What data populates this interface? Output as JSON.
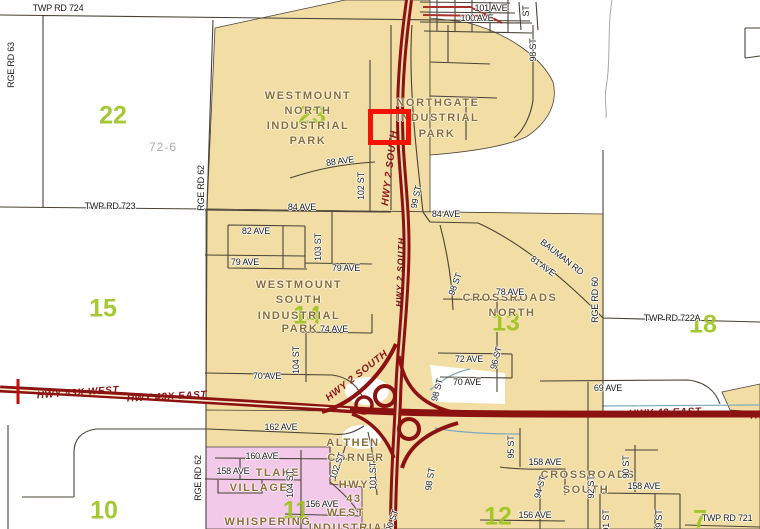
{
  "colors": {
    "tan": "#F2DEA5",
    "pink": "#F2C9E9",
    "hwy": "#8C1111",
    "selection": "#F31208",
    "section": "#9CC41F",
    "place": "#8A6D35",
    "street": "#1C1C1C",
    "hwylabel": "#8A1515",
    "teal": "#7FA9BE",
    "creek": "#A8A8A8",
    "road": "#4A4238"
  },
  "selection": {
    "x": 368,
    "y": 109,
    "w": 33,
    "h": 26
  },
  "labels": [
    {
      "t": "22",
      "x": 113,
      "y": 116,
      "r": 0,
      "c": "section"
    },
    {
      "t": "23",
      "x": 312,
      "y": 116,
      "r": 0,
      "c": "section"
    },
    {
      "t": "15",
      "x": 103,
      "y": 309,
      "r": 0,
      "c": "section"
    },
    {
      "t": "14",
      "x": 307,
      "y": 316,
      "r": 0,
      "c": "section"
    },
    {
      "t": "13",
      "x": 506,
      "y": 323,
      "r": 0,
      "c": "section"
    },
    {
      "t": "18",
      "x": 703,
      "y": 325,
      "r": 0,
      "c": "section"
    },
    {
      "t": "10",
      "x": 104,
      "y": 511,
      "r": 0,
      "c": "section"
    },
    {
      "t": "11",
      "x": 296,
      "y": 511,
      "r": 0,
      "c": "section"
    },
    {
      "t": "12",
      "x": 498,
      "y": 517,
      "r": 0,
      "c": "section"
    },
    {
      "t": "7",
      "x": 700,
      "y": 520,
      "r": 0,
      "c": "section"
    },
    {
      "t": "72-6",
      "x": 163,
      "y": 147,
      "r": 0,
      "c": "lot"
    },
    {
      "t": "WESTMOUNT",
      "x": 308,
      "y": 96,
      "r": 0,
      "c": "place"
    },
    {
      "t": "NORTH",
      "x": 308,
      "y": 111,
      "r": 0,
      "c": "place"
    },
    {
      "t": "INDUSTRIAL",
      "x": 308,
      "y": 126,
      "r": 0,
      "c": "place"
    },
    {
      "t": "PARK",
      "x": 308,
      "y": 141,
      "r": 0,
      "c": "place"
    },
    {
      "t": "NORTHGATE",
      "x": 438,
      "y": 103,
      "r": 0,
      "c": "place"
    },
    {
      "t": "INDUSTRIAL",
      "x": 438,
      "y": 118,
      "r": 0,
      "c": "place"
    },
    {
      "t": "PARK",
      "x": 437,
      "y": 134,
      "r": 0,
      "c": "place"
    },
    {
      "t": "WESTMOUNT",
      "x": 299,
      "y": 285,
      "r": 0,
      "c": "place"
    },
    {
      "t": "SOUTH",
      "x": 299,
      "y": 300,
      "r": 0,
      "c": "place"
    },
    {
      "t": "INDUSTRIAL",
      "x": 299,
      "y": 316,
      "r": 0,
      "c": "place"
    },
    {
      "t": "PARK",
      "x": 300,
      "y": 329,
      "r": 0,
      "c": "place"
    },
    {
      "t": "CROSSROADS",
      "x": 510,
      "y": 298,
      "r": 0,
      "c": "place"
    },
    {
      "t": "NORTH",
      "x": 512,
      "y": 313,
      "r": 0,
      "c": "place"
    },
    {
      "t": "CROSSROADS",
      "x": 588,
      "y": 475,
      "r": 0,
      "c": "place"
    },
    {
      "t": "SOUTH",
      "x": 586,
      "y": 490,
      "r": 0,
      "c": "place"
    },
    {
      "t": "ALTHEN",
      "x": 353,
      "y": 443,
      "r": 0,
      "c": "place"
    },
    {
      "t": "CORNER",
      "x": 356,
      "y": 458,
      "r": 0,
      "c": "place"
    },
    {
      "t": "HWY",
      "x": 354,
      "y": 485,
      "r": 0,
      "c": "place"
    },
    {
      "t": "43",
      "x": 354,
      "y": 499,
      "r": 0,
      "c": "place"
    },
    {
      "t": "TLAKE",
      "x": 278,
      "y": 473,
      "r": 0,
      "c": "place"
    },
    {
      "t": "VILLAGE",
      "x": 259,
      "y": 488,
      "r": 0,
      "c": "place"
    },
    {
      "t": "WHISPERING",
      "x": 268,
      "y": 522,
      "r": 0,
      "c": "place"
    },
    {
      "t": "WEST",
      "x": 346,
      "y": 513,
      "r": 0,
      "c": "place"
    },
    {
      "t": "INDUSTRIAL",
      "x": 350,
      "y": 528,
      "r": 0,
      "c": "place"
    },
    {
      "t": "HWY 43X WEST",
      "x": 78,
      "y": 393,
      "r": -4,
      "c": "hwyl"
    },
    {
      "t": "HWY 43X EAST",
      "x": 167,
      "y": 397,
      "r": -3,
      "c": "hwyl"
    },
    {
      "t": "HWY 43 EAST",
      "x": 665,
      "y": 413,
      "r": -2,
      "c": "hwyl"
    },
    {
      "t": "HWY 43 EAST",
      "x": 787,
      "y": 415,
      "r": -2,
      "c": "hwyl"
    },
    {
      "t": "HWY 2 SOUTH",
      "x": 357,
      "y": 376,
      "r": -38,
      "c": "hwyl"
    },
    {
      "t": "HWY 2 SOUTH",
      "x": 390,
      "y": 168,
      "r": -83,
      "c": "hwyl"
    },
    {
      "t": "HWY 2 SOUTH",
      "x": 400,
      "y": 272,
      "r": -88,
      "c": "hwyl sm"
    },
    {
      "t": "TWP RD 724",
      "x": 58,
      "y": 8,
      "r": 0,
      "c": "street"
    },
    {
      "t": "RGE RD 63",
      "x": 11,
      "y": 65,
      "r": -90,
      "c": "street"
    },
    {
      "t": "TWP RD 723",
      "x": 110,
      "y": 206,
      "r": 0,
      "c": "street"
    },
    {
      "t": "RGE RD 62",
      "x": 201,
      "y": 188,
      "r": -90,
      "c": "street"
    },
    {
      "t": "RGE RD 62",
      "x": 198,
      "y": 478,
      "r": -90,
      "c": "street"
    },
    {
      "t": "RGE RD 60",
      "x": 595,
      "y": 300,
      "r": -90,
      "c": "street"
    },
    {
      "t": "TWP RD 722A",
      "x": 672,
      "y": 318,
      "r": 0,
      "c": "street"
    },
    {
      "t": "TWP RD 721",
      "x": 727,
      "y": 518,
      "r": 0,
      "c": "street"
    },
    {
      "t": "BAUMAN RD",
      "x": 562,
      "y": 257,
      "r": 38,
      "c": "street"
    },
    {
      "t": "81 AVE",
      "x": 543,
      "y": 266,
      "r": 36,
      "c": "street"
    },
    {
      "t": "84 AVE",
      "x": 302,
      "y": 207,
      "r": 0,
      "c": "street"
    },
    {
      "t": "84 AVE",
      "x": 446,
      "y": 214,
      "r": 0,
      "c": "street"
    },
    {
      "t": "88 AVE",
      "x": 340,
      "y": 161,
      "r": -8,
      "c": "street"
    },
    {
      "t": "82 AVE",
      "x": 256,
      "y": 231,
      "r": 0,
      "c": "street"
    },
    {
      "t": "79 AVE",
      "x": 245,
      "y": 262,
      "r": 0,
      "c": "street"
    },
    {
      "t": "79 AVE",
      "x": 346,
      "y": 268,
      "r": 0,
      "c": "street"
    },
    {
      "t": "74 AVE",
      "x": 334,
      "y": 329,
      "r": 0,
      "c": "street"
    },
    {
      "t": "70 AVE",
      "x": 267,
      "y": 376,
      "r": 0,
      "c": "street"
    },
    {
      "t": "72 AVE",
      "x": 469,
      "y": 359,
      "r": 0,
      "c": "street"
    },
    {
      "t": "70 AVE",
      "x": 467,
      "y": 382,
      "r": 0,
      "c": "street"
    },
    {
      "t": "69 AVE",
      "x": 608,
      "y": 388,
      "r": 0,
      "c": "street"
    },
    {
      "t": "78 AVE",
      "x": 510,
      "y": 292,
      "r": 0,
      "c": "street"
    },
    {
      "t": "101 AVE",
      "x": 491,
      "y": 8,
      "r": 0,
      "c": "street"
    },
    {
      "t": "100 AVE",
      "x": 477,
      "y": 18,
      "r": 0,
      "c": "street"
    },
    {
      "t": "ST",
      "x": 526,
      "y": 11,
      "r": -90,
      "c": "street"
    },
    {
      "t": "98 ST",
      "x": 533,
      "y": 50,
      "r": -90,
      "c": "street"
    },
    {
      "t": "99 ST",
      "x": 416,
      "y": 197,
      "r": -78,
      "c": "street"
    },
    {
      "t": "98 ST",
      "x": 455,
      "y": 284,
      "r": -70,
      "c": "street"
    },
    {
      "t": "96 ST",
      "x": 496,
      "y": 358,
      "r": -75,
      "c": "street"
    },
    {
      "t": "95 ST",
      "x": 511,
      "y": 447,
      "r": -90,
      "c": "street"
    },
    {
      "t": "94 ST",
      "x": 540,
      "y": 487,
      "r": -75,
      "c": "street"
    },
    {
      "t": "92 ST",
      "x": 591,
      "y": 487,
      "r": -90,
      "c": "street"
    },
    {
      "t": "90 ST",
      "x": 626,
      "y": 467,
      "r": -90,
      "c": "street"
    },
    {
      "t": "91 ST",
      "x": 606,
      "y": 521,
      "r": -90,
      "c": "street"
    },
    {
      "t": "89 ST",
      "x": 659,
      "y": 521,
      "r": -90,
      "c": "street"
    },
    {
      "t": "98 ST",
      "x": 437,
      "y": 390,
      "r": -75,
      "c": "street"
    },
    {
      "t": "98 ST",
      "x": 430,
      "y": 479,
      "r": -80,
      "c": "street"
    },
    {
      "t": "102 ST",
      "x": 361,
      "y": 186,
      "r": -90,
      "c": "street"
    },
    {
      "t": "103 ST",
      "x": 318,
      "y": 247,
      "r": -90,
      "c": "street"
    },
    {
      "t": "104 ST",
      "x": 296,
      "y": 360,
      "r": -90,
      "c": "street"
    },
    {
      "t": "104 ST",
      "x": 290,
      "y": 484,
      "r": -90,
      "c": "street"
    },
    {
      "t": "102 ST",
      "x": 337,
      "y": 466,
      "r": -70,
      "c": "street"
    },
    {
      "t": "101 ST",
      "x": 373,
      "y": 476,
      "r": -90,
      "c": "street"
    },
    {
      "t": "100 ST",
      "x": 391,
      "y": 523,
      "r": -70,
      "c": "street"
    },
    {
      "t": "158 AVE",
      "x": 545,
      "y": 462,
      "r": 0,
      "c": "street"
    },
    {
      "t": "158 AVE",
      "x": 644,
      "y": 486,
      "r": 0,
      "c": "street"
    },
    {
      "t": "156 AVE",
      "x": 535,
      "y": 515,
      "r": 0,
      "c": "street"
    },
    {
      "t": "156 AVE",
      "x": 322,
      "y": 504,
      "r": 0,
      "c": "street"
    },
    {
      "t": "162 AVE",
      "x": 281,
      "y": 427,
      "r": 0,
      "c": "street"
    },
    {
      "t": "160 AVE",
      "x": 262,
      "y": 456,
      "r": 0,
      "c": "street"
    },
    {
      "t": "158 AVE",
      "x": 233,
      "y": 471,
      "r": 0,
      "c": "street"
    }
  ]
}
